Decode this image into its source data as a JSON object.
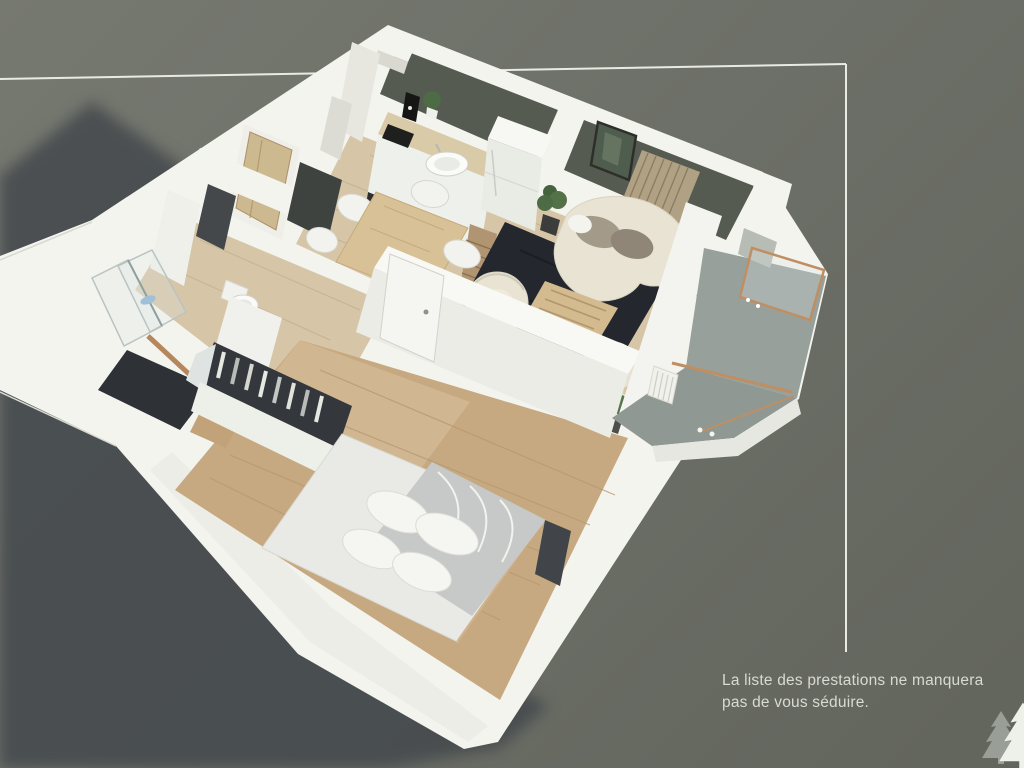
{
  "caption": {
    "line1": "La liste des prestations ne manquera",
    "line2": "pas de vous séduire."
  },
  "logo": {
    "icon": "fir-trees-icon"
  },
  "scene": {
    "subject": "3d-isometric-apartment-floorplan-render"
  },
  "colors": {
    "bg_top": "#767970",
    "bg_bottom": "#62655c",
    "shadow": "#42474c",
    "frame_line": "#f1f1ec",
    "wall": "#f4f4ef",
    "wall_shade": "#e7e7e0",
    "interior_wall_dark": "#565b51",
    "wood_light": "#d6c6a7",
    "wood_warm": "#c7a981",
    "wood_table": "#d8c196",
    "rug": "#24272d",
    "sofa_cream": "#e8e3d3",
    "cushion": "#a39a8a",
    "duvet": "#c6c9c7",
    "copper": "#bf8f63",
    "balcony_floor": "#97a09b",
    "plant_green": "#4d6b44",
    "opening_dark": "#34383d",
    "text": "#d9dbd3",
    "tree_gray": "#999e96",
    "tree_white": "#eef0ea"
  }
}
